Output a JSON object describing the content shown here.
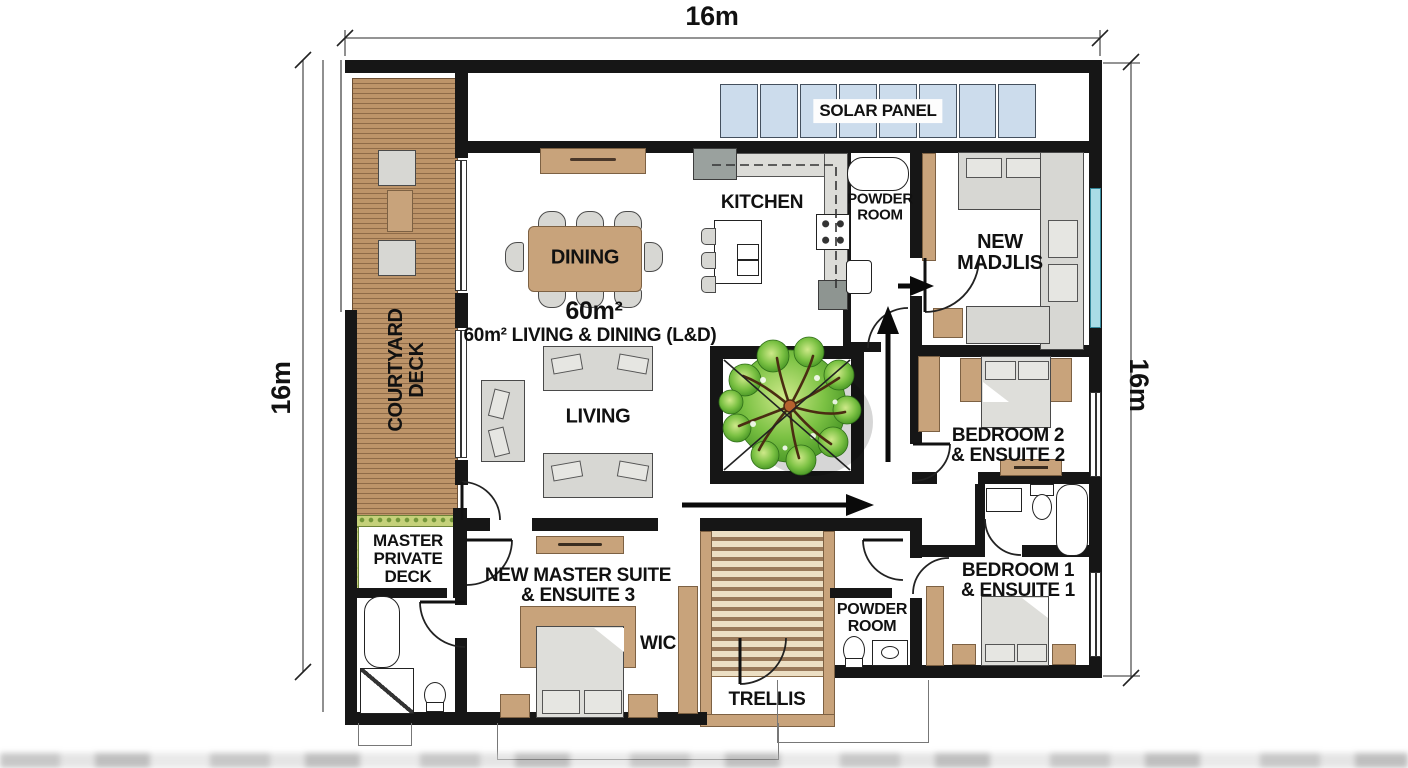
{
  "dimensions": {
    "top": "16m",
    "left": "16m",
    "right": "16m"
  },
  "labels": {
    "solar_panel": "SOLAR PANEL",
    "kitchen": "KITCHEN",
    "dining": "DINING",
    "area_value": "60m²",
    "area_caption": "60m² LIVING & DINING (L&D)",
    "living": "LIVING",
    "courtyard_deck": "COURTYARD\nDECK",
    "powder_room_top": "POWDER\nROOM",
    "new_madjlis": "NEW\nMADJLIS",
    "bedroom2": "BEDROOM 2\n& ENSUITE 2",
    "bedroom1": "BEDROOM 1\n& ENSUITE 1",
    "master_private_deck": "MASTER\nPRIVATE\nDECK",
    "new_master_suite": "NEW MASTER SUITE\n& ENSUITE 3",
    "wic": "WIC",
    "powder_room_bottom": "POWDER\nROOM",
    "trellis": "TRELLIS"
  },
  "colors": {
    "wall": "#161616",
    "ink": "#111111",
    "wood": "#bd9469",
    "wood_stripe": "#8f6b48",
    "trellis_stripe": "#99795a",
    "tan": "#c8a37b",
    "tan_border": "#7d6143",
    "grey": "#d7d7d3",
    "grey_border": "#4a4a4a",
    "solar": "#ccdcec",
    "glazing": "#a9dce6",
    "grass": "#c5d17a",
    "tree_green": "#55a42d"
  }
}
